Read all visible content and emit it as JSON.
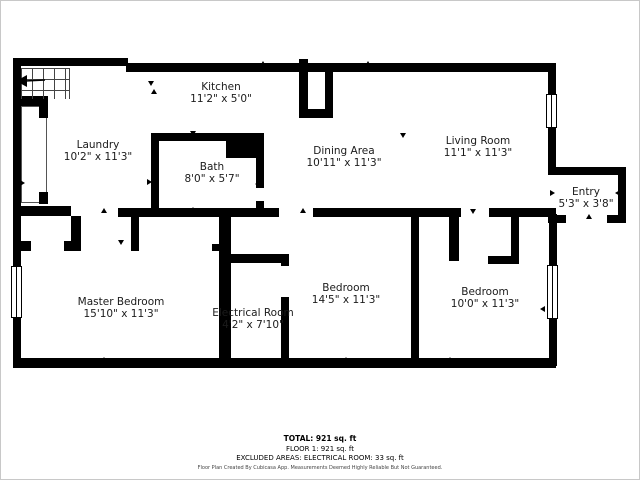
{
  "footer": {
    "total": "TOTAL: 921 sq. ft",
    "floor": "FLOOR 1: 921 sq. ft",
    "excluded": "EXCLUDED AREAS: ELECTRICAL ROOM: 33 sq. ft",
    "disclaimer": "Floor Plan Created By Cubicasa App. Measurements Deemed Highly Reliable But Not Guaranteed."
  },
  "rooms": {
    "kitchen": {
      "name": "Kitchen",
      "dims": "11'2\" x 5'0\""
    },
    "laundry": {
      "name": "Laundry",
      "dims": "10'2\" x 11'3\""
    },
    "bath": {
      "name": "Bath",
      "dims": "8'0\" x 5'7\""
    },
    "dining": {
      "name": "Dining Area",
      "dims": "10'11\" x 11'3\""
    },
    "living": {
      "name": "Living Room",
      "dims": "11'1\" x 11'3\""
    },
    "entry": {
      "name": "Entry",
      "dims": "5'3\" x 3'8\""
    },
    "master": {
      "name": "Master Bedroom",
      "dims": "15'10\" x 11'3\""
    },
    "electrical": {
      "name": "Electrical Room",
      "dims": "4'2\" x 7'10\""
    },
    "bedroom_a": {
      "name": "Bedroom",
      "dims": "14'5\" x 11'3\""
    },
    "bedroom_b": {
      "name": "Bedroom",
      "dims": "10'0\" x 11'3\""
    }
  },
  "floorplan": {
    "wall_color": "#000000",
    "walls": [
      [
        12,
        57,
        115,
        8
      ],
      [
        125,
        62,
        430,
        9
      ],
      [
        12,
        57,
        8,
        208
      ],
      [
        12,
        317,
        8,
        50
      ],
      [
        12,
        357,
        543,
        10
      ],
      [
        547,
        62,
        8,
        34
      ],
      [
        547,
        126,
        8,
        48
      ],
      [
        548,
        213,
        8,
        52
      ],
      [
        548,
        318,
        8,
        47
      ],
      [
        547,
        166,
        78,
        8
      ],
      [
        617,
        166,
        8,
        56
      ],
      [
        547,
        214,
        18,
        8
      ],
      [
        606,
        214,
        19,
        8
      ],
      [
        12,
        95,
        35,
        10
      ],
      [
        38,
        105,
        9,
        12
      ],
      [
        38,
        191,
        9,
        12
      ],
      [
        12,
        205,
        58,
        10
      ],
      [
        117,
        207,
        161,
        9
      ],
      [
        312,
        207,
        148,
        9
      ],
      [
        488,
        207,
        67,
        9
      ],
      [
        150,
        132,
        113,
        8
      ],
      [
        150,
        132,
        8,
        84
      ],
      [
        225,
        138,
        38,
        19
      ],
      [
        255,
        157,
        8,
        30
      ],
      [
        255,
        200,
        8,
        16
      ],
      [
        298,
        58,
        9,
        59
      ],
      [
        298,
        108,
        34,
        9
      ],
      [
        324,
        71,
        8,
        46
      ],
      [
        70,
        215,
        10,
        35
      ],
      [
        130,
        215,
        8,
        35
      ],
      [
        12,
        240,
        18,
        10
      ],
      [
        63,
        240,
        17,
        10
      ],
      [
        211,
        243,
        7,
        7
      ],
      [
        218,
        215,
        12,
        152
      ],
      [
        220,
        253,
        68,
        9
      ],
      [
        280,
        253,
        8,
        12
      ],
      [
        280,
        296,
        8,
        71
      ],
      [
        410,
        215,
        8,
        152
      ],
      [
        448,
        215,
        10,
        45
      ],
      [
        510,
        216,
        8,
        47
      ],
      [
        487,
        255,
        31,
        8
      ]
    ],
    "windows": [
      [
        10,
        265,
        11,
        52
      ],
      [
        545,
        93,
        11,
        34
      ],
      [
        546,
        264,
        11,
        54
      ]
    ],
    "markers": [
      [
        262,
        64,
        "up"
      ],
      [
        367,
        64,
        "up"
      ],
      [
        470,
        66,
        "up"
      ],
      [
        88,
        63,
        "up"
      ],
      [
        150,
        84,
        "down"
      ],
      [
        153,
        92,
        "up"
      ],
      [
        192,
        134,
        "down"
      ],
      [
        150,
        181,
        "right"
      ],
      [
        258,
        183,
        "left"
      ],
      [
        192,
        210,
        "up"
      ],
      [
        103,
        211,
        "up"
      ],
      [
        23,
        182,
        "right"
      ],
      [
        302,
        211,
        "up"
      ],
      [
        350,
        212,
        "down"
      ],
      [
        402,
        136,
        "down"
      ],
      [
        103,
        360,
        "up"
      ],
      [
        253,
        257,
        "up"
      ],
      [
        253,
        361,
        "up"
      ],
      [
        345,
        360,
        "up"
      ],
      [
        120,
        243,
        "down"
      ],
      [
        449,
        360,
        "up"
      ],
      [
        472,
        212,
        "down"
      ],
      [
        543,
        308,
        "left"
      ],
      [
        590,
        172,
        "down"
      ],
      [
        553,
        192,
        "right"
      ],
      [
        618,
        192,
        "left"
      ],
      [
        588,
        217,
        "up"
      ]
    ]
  }
}
